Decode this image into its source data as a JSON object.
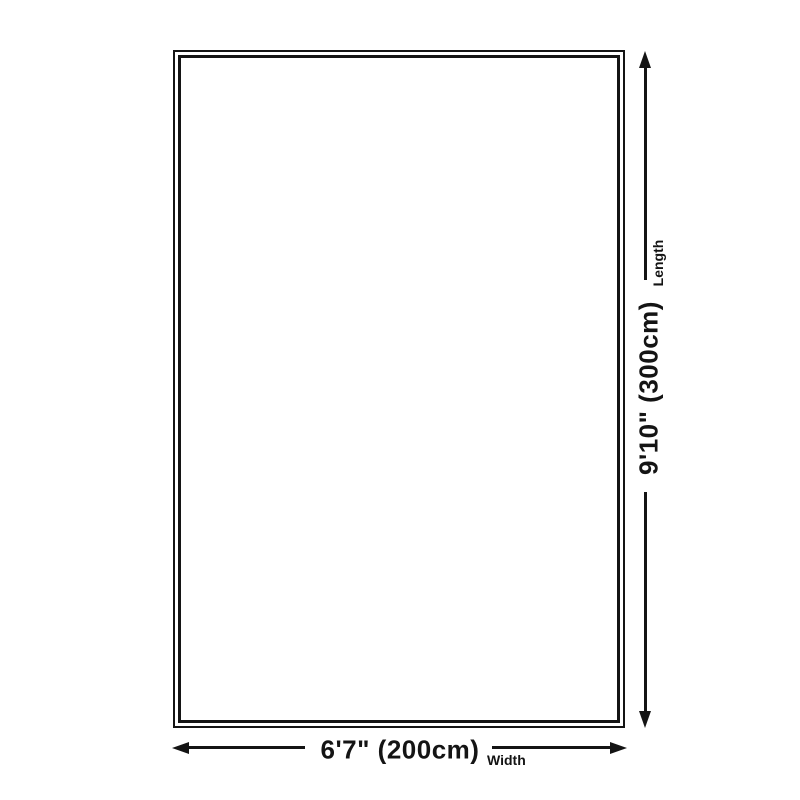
{
  "diagram": {
    "background_color": "#ffffff",
    "line_color": "#141414",
    "rug_shape": "rectangle-double-outline",
    "length": {
      "value": "9'10\" (300cm)",
      "axis": "Length"
    },
    "width": {
      "value": "6'7\" (200cm)",
      "axis": "Width"
    }
  }
}
